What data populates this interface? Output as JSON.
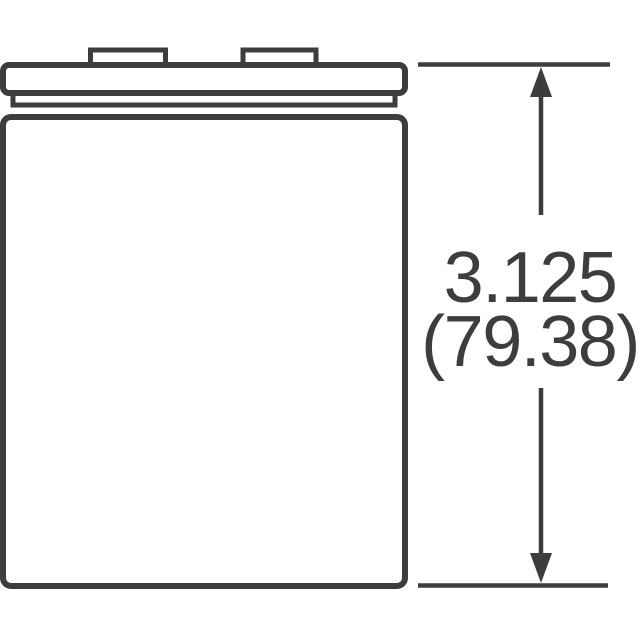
{
  "diagram": {
    "kind": "technical-dimension-drawing",
    "subject": "capacitor-can-side-view",
    "dimension": {
      "inches": "3.125",
      "millimeters": "(79.38)"
    },
    "colors": {
      "line": "#3d3d3f",
      "fill": "#ffffff",
      "background": "#ffffff"
    }
  }
}
